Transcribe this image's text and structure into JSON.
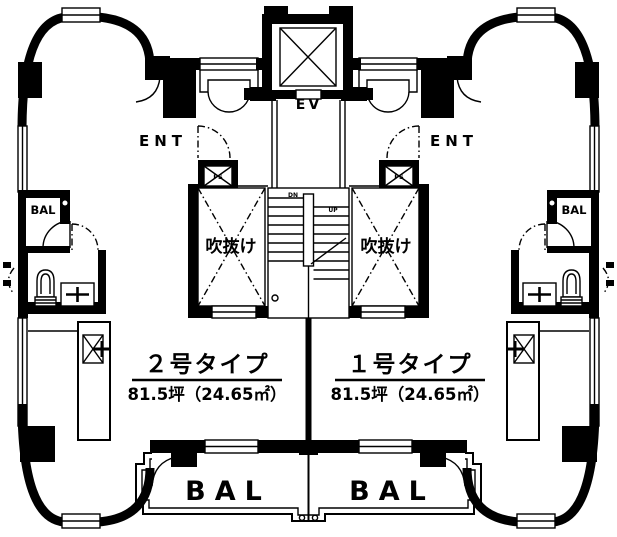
{
  "plan": {
    "labels": {
      "elevator": "EV",
      "entrance_left": "ENT",
      "entrance_right": "ENT",
      "void_left": "吹抜け",
      "void_right": "吹抜け",
      "balcony_side_left": "BAL",
      "balcony_side_right": "BAL",
      "balcony_bottom_left": "BAL",
      "balcony_bottom_right": "BAL",
      "pipe_space_left": "PS",
      "pipe_space_right": "PS",
      "stair_down": "DN",
      "stair_up": "UP"
    },
    "units": [
      {
        "name": "２号タイプ",
        "area": "81.5坪（24.65㎡）"
      },
      {
        "name": "１号タイプ",
        "area": "81.5坪（24.65㎡）"
      }
    ],
    "colors": {
      "wall": "#000000",
      "background": "#ffffff"
    }
  }
}
